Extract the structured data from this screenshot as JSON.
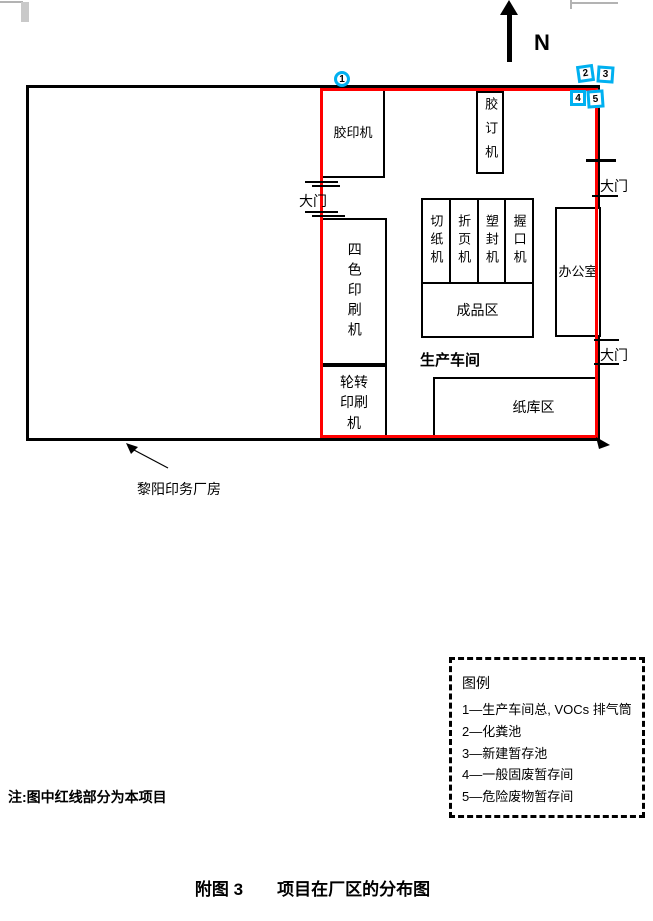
{
  "compass": {
    "north_label": "N"
  },
  "factory": {
    "building_label": "黎阳印务厂房",
    "workshop_label": "生产车间",
    "gate_label": "大门",
    "rooms": {
      "offset_press": "胶印机",
      "binding_machine": "胶订机",
      "paper_cutter": "切纸机",
      "folding_machine": "折页机",
      "laminating_machine": "塑封机",
      "gripper_machine": "握口机",
      "finished_goods_area": "成品区",
      "office": "办公室",
      "four_color_press": "四色印刷机",
      "rotary_press": "轮转印刷机",
      "paper_storage": "纸库区"
    }
  },
  "markers": {
    "m1": "1",
    "m2": "2",
    "m3": "3",
    "m4": "4",
    "m5": "5"
  },
  "legend": {
    "title": "图例",
    "items": [
      "1—生产车间总, VOCs 排气筒",
      "2—化粪池",
      "3—新建暂存池",
      "4—一般固废暂存间",
      "5—危险废物暂存间"
    ]
  },
  "note": "注:图中红线部分为本项目",
  "caption": "附图 3　　项目在厂区的分布图",
  "colors": {
    "project_outline": "#ff0000",
    "marker_accent": "#00b0f0"
  }
}
